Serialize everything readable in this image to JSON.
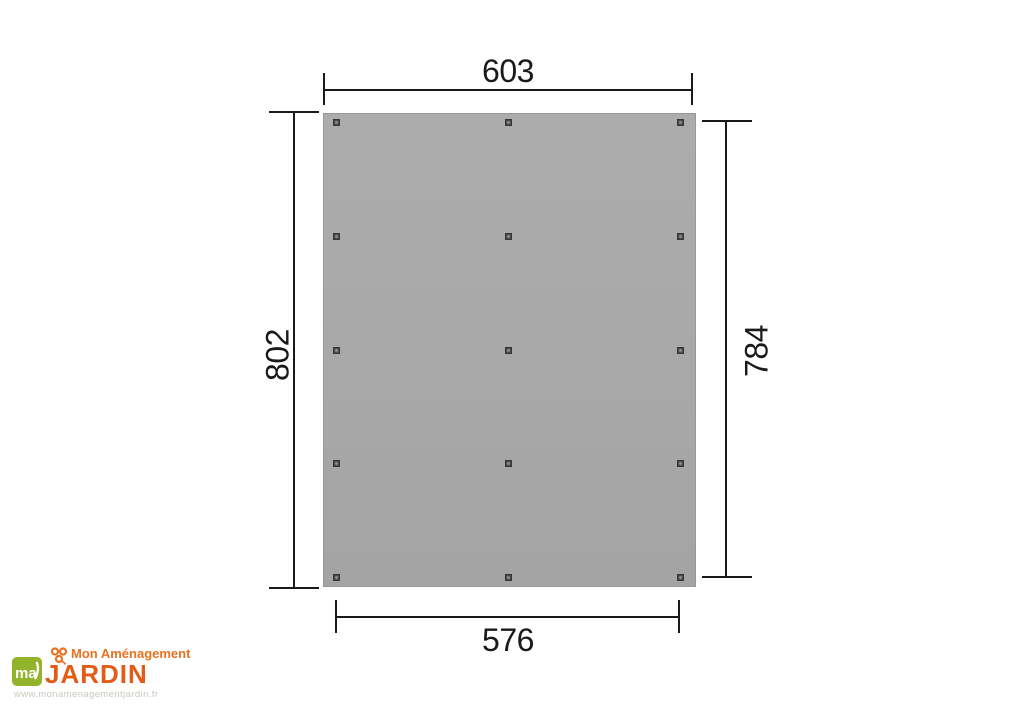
{
  "diagram": {
    "type": "technical-dimension-drawing",
    "unit_labels": {
      "top": "603",
      "left": "802",
      "right": "784",
      "bottom": "576"
    },
    "posts": {
      "columns": 3,
      "rows": 5
    },
    "colors": {
      "panel_fill": "#a8a8a8",
      "panel_border": "#989898",
      "post_fill": "#48484a",
      "dimension_line": "#1a1a1a"
    }
  },
  "logo": {
    "mark_text": "ma",
    "brand_top": "Mon Aménagement",
    "brand_main": "JARDIN",
    "url": "www.monamenagementjardin.fr",
    "colors": {
      "orange": "#e8721f",
      "dark_orange": "#e25c18",
      "green": "#93b32a",
      "url_gray": "#cbc7bf"
    }
  }
}
